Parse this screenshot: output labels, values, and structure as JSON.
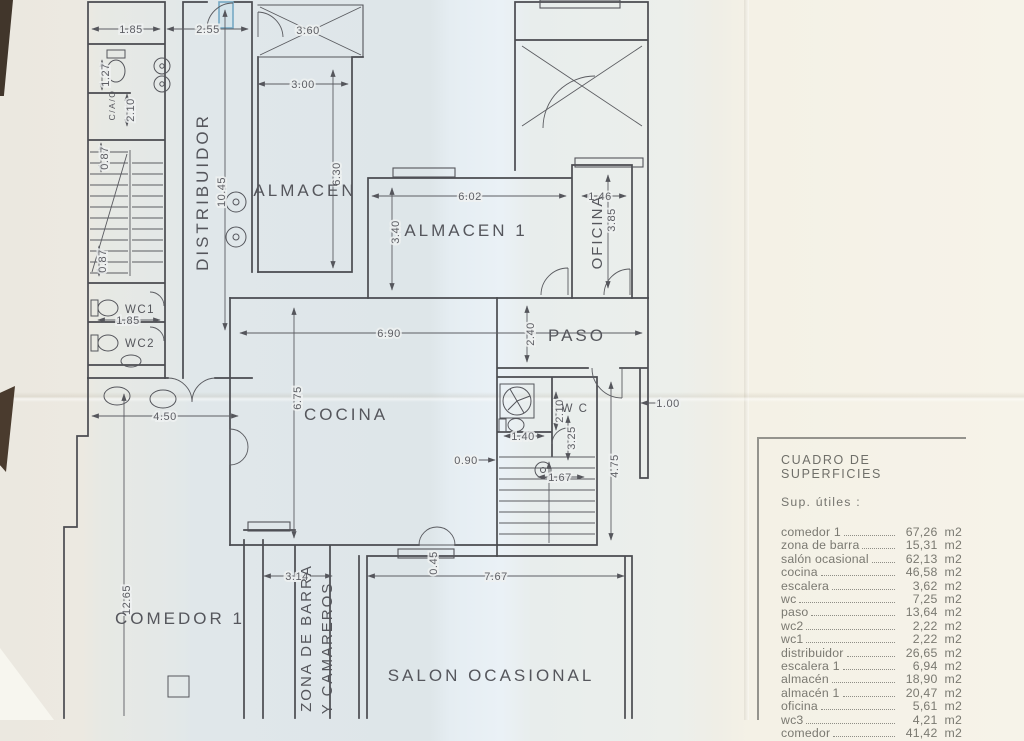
{
  "plan": {
    "rooms": {
      "distribuidor": "DISTRIBUIDOR",
      "almacen": "ALMACEN",
      "almacen1": "ALMACEN 1",
      "oficina": "OFICINA",
      "paso": "PASO",
      "cocina": "COCINA",
      "wc": "W C",
      "wc1": "WC1",
      "wc2": "WC2",
      "aseo": "C/A/O",
      "comedor1": "COMEDOR 1",
      "zona_barra": "ZONA DE BARRA",
      "camareros": "Y CAMAREROS",
      "salon": "SALON OCASIONAL"
    },
    "dims": {
      "a185": "1.85",
      "a255": "2.55",
      "a360": "3.60",
      "a300": "3.00",
      "a127": "1.27",
      "a210": "2.10",
      "a087a": "0.87",
      "a087b": "0.87",
      "a1045": "10.45",
      "a630": "6.30",
      "a602": "6.02",
      "a340": "3.40",
      "a146": "1.46",
      "a385": "3.85",
      "b185": "1.85",
      "a690": "6.90",
      "a240": "2.40",
      "a450": "4.50",
      "a675": "6.75",
      "b210": "2.10",
      "a325": "3.25",
      "a140": "1.40",
      "a090": "0.90",
      "a167": "1.67",
      "a475": "4.75",
      "a100": "1.00",
      "a1265": "12.65",
      "a314": "3.14",
      "a767": "7.67",
      "a045": "0.45"
    }
  },
  "surface_table": {
    "title": "CUADRO DE SUPERFICIES",
    "subtitle": "Sup. útiles :",
    "unit": "m2",
    "rows": [
      {
        "name": "comedor 1",
        "value": "67,26"
      },
      {
        "name": "zona de barra",
        "value": "15,31"
      },
      {
        "name": "salón ocasional",
        "value": "62,13"
      },
      {
        "name": "cocina",
        "value": "46,58"
      },
      {
        "name": "escalera",
        "value": "3,62"
      },
      {
        "name": "wc",
        "value": "7,25"
      },
      {
        "name": "paso",
        "value": "13,64"
      },
      {
        "name": "wc2",
        "value": "2,22"
      },
      {
        "name": "wc1",
        "value": "2,22"
      },
      {
        "name": "distribuidor",
        "value": "26,65"
      },
      {
        "name": "escalera 1",
        "value": "6,94"
      },
      {
        "name": "almacén",
        "value": "18,90"
      },
      {
        "name": "almacén 1",
        "value": "20,47"
      },
      {
        "name": "oficina",
        "value": "5,61"
      },
      {
        "name": "wc3",
        "value": "4,21"
      },
      {
        "name": "comedor",
        "value": "41,42"
      }
    ]
  }
}
